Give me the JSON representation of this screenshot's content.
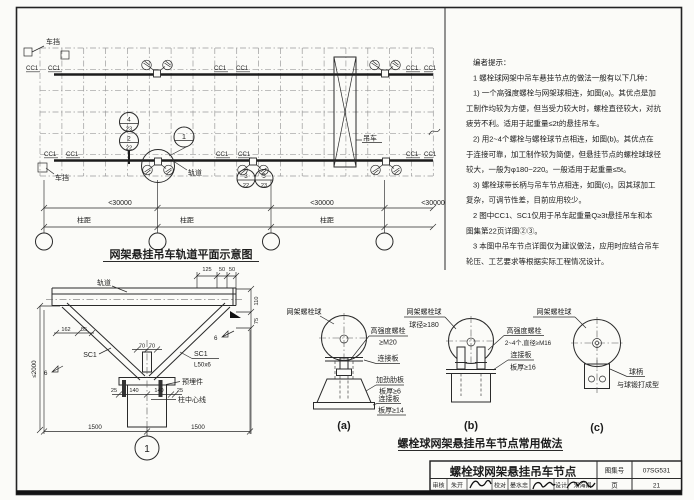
{
  "plan": {
    "title": "网架悬挂吊车轨道平面示意图",
    "cc1": "CC1",
    "chedang": "车挡",
    "diaoche": "吊车",
    "guidao": "轨道",
    "dim_span": "<30000",
    "zhuju": "柱距",
    "ref1_top": "4",
    "ref1_bot": "23",
    "ref2_top": "2",
    "ref2_bot": "22",
    "ref3_top": "3",
    "ref3_bot": "22",
    "ref4_top": "5",
    "ref4_bot": "23",
    "detail_bubble": "1"
  },
  "notes": {
    "lines": [
      "编者提示：",
      "1 螺栓球网架中吊车悬挂节点的做法一般有以下几种：",
      "1) 一个高强度螺栓与网架球相连，如图(a)。其优点是加",
      "工制作均较为方便，但当受力较大时，螺栓直径较大，对抗",
      "疲劳不利。适用于起重量≤2t的悬挂吊车。",
      "2) 用2~4个螺栓与螺栓球节点相连，如图(b)。其优点在",
      "于连接可靠，加工制作较为简便，但悬挂节点的螺栓球球径",
      "较大，一般为φ180~220。一般适用于起重量≤5t。",
      "3) 螺栓球带长柄与吊车节点相连，如图(c)。因其球加工",
      "复杂，可调节性差，目前应用较少。",
      "2 图中CC1、SC1仅用于吊车起重量Q≥3t悬挂吊车和本",
      "图集第22页详图②③。",
      "3 本图中吊车节点详图仅为建议做法，应用时应结合吊车",
      "轮压、工艺要求等根据实际工程情况设计。"
    ]
  },
  "section": {
    "guidao": "轨道",
    "sc1": "SC1",
    "l50x6": "L50x6",
    "weld": "6",
    "maijian": "预埋件",
    "centerline": "柱中心线",
    "d2000": "≤2000",
    "d162": "162",
    "d85": "85",
    "d70": "70",
    "d125": "125",
    "d50": "50",
    "d110": "110",
    "d75": "75",
    "d25": "25",
    "d140": "140",
    "d1500": "1500",
    "bubble": "1"
  },
  "details": {
    "title": "螺栓球网架悬挂吊车节点常用做法",
    "a": {
      "cap": "(a)",
      "ball": "网架螺栓球",
      "bolt1": "高强度螺栓",
      "bolt2": "≥M20",
      "plate1": "连接板",
      "rib1": "加劲肋板",
      "rib2": "板厚≥6",
      "plate2": "连接板",
      "plate2b": "板厚≥14"
    },
    "b": {
      "cap": "(b)",
      "ball1": "网架螺栓球",
      "ball2": "球径≥180",
      "bolt1": "高强度螺栓",
      "bolt2": "2~4个,直径≥M16",
      "plate1": "连接板",
      "plate2": "板厚≥16"
    },
    "c": {
      "cap": "(c)",
      "ball": "网架螺栓球",
      "stem1": "球柄",
      "stem2": "与球锻打成型"
    }
  },
  "titleblock": {
    "title": "螺栓球网架悬挂吊车节点",
    "atlas_label": "图集号",
    "atlas_no": "07SG531",
    "page_label": "页",
    "page_no": "21",
    "r1": "审核",
    "n1": "朱开",
    "r2": "校对",
    "n2": "晏水忠",
    "r3": "设计",
    "n3": "宋海娟"
  }
}
